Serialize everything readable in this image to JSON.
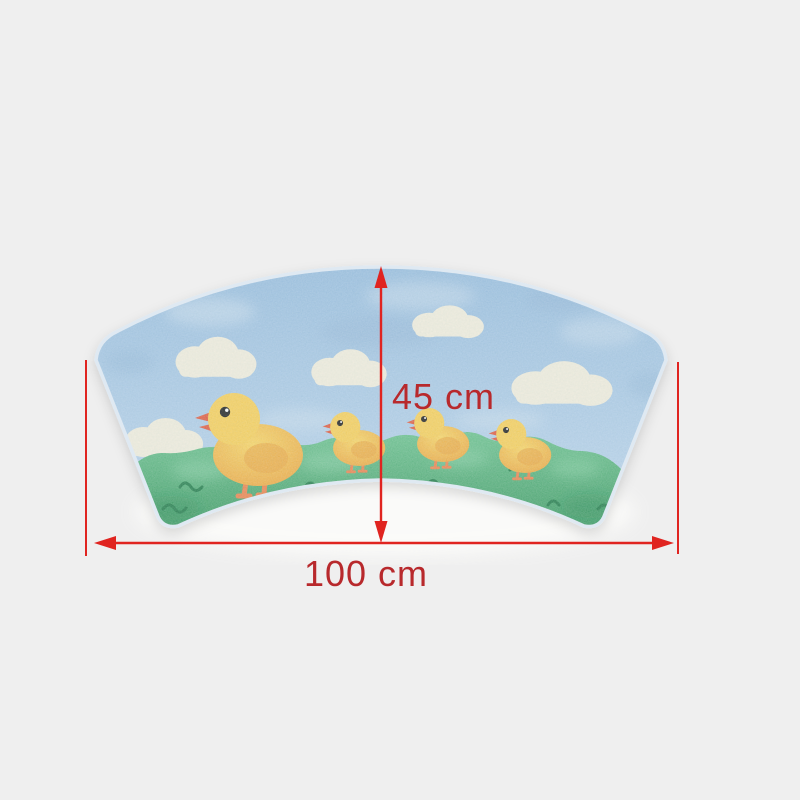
{
  "scene": {
    "description": "Product photo of a fan-shaped children's rug showing a mother duck and three ducklings on grass under a blue sky with clouds, annotated with red dimension arrows",
    "background_color": "#efefef"
  },
  "dimensions": {
    "height_label": "45 cm",
    "width_label": "100 cm"
  },
  "annotation_colors": {
    "arrow": "#e02420",
    "text": "#b8292c"
  },
  "rug": {
    "shape": "curved fan / arc segment",
    "duck_count": 4,
    "cloud_count": 5,
    "sky_top": "#97bddf",
    "sky_bottom": "#b8d3eb",
    "sky_light_patch": "#cfe1f0",
    "sky_dark_patch": "#86abd0",
    "cloud": "#f3eedd",
    "grass_top": "#69c28c",
    "grass_bottom": "#2c8f53",
    "grass_dark": "#1d7a45",
    "grass_light": "#8fd6a9",
    "duck_head": "#f9cf55",
    "duck_body_light": "#fbd55e",
    "duck_body_dark": "#efa43a",
    "duck_wing": "#eda43c",
    "duck_beak": "#e2573a",
    "duck_leg": "#ee8148",
    "duck_eye": "#1a1a1a",
    "edge_highlight": "#dfe9f2"
  }
}
